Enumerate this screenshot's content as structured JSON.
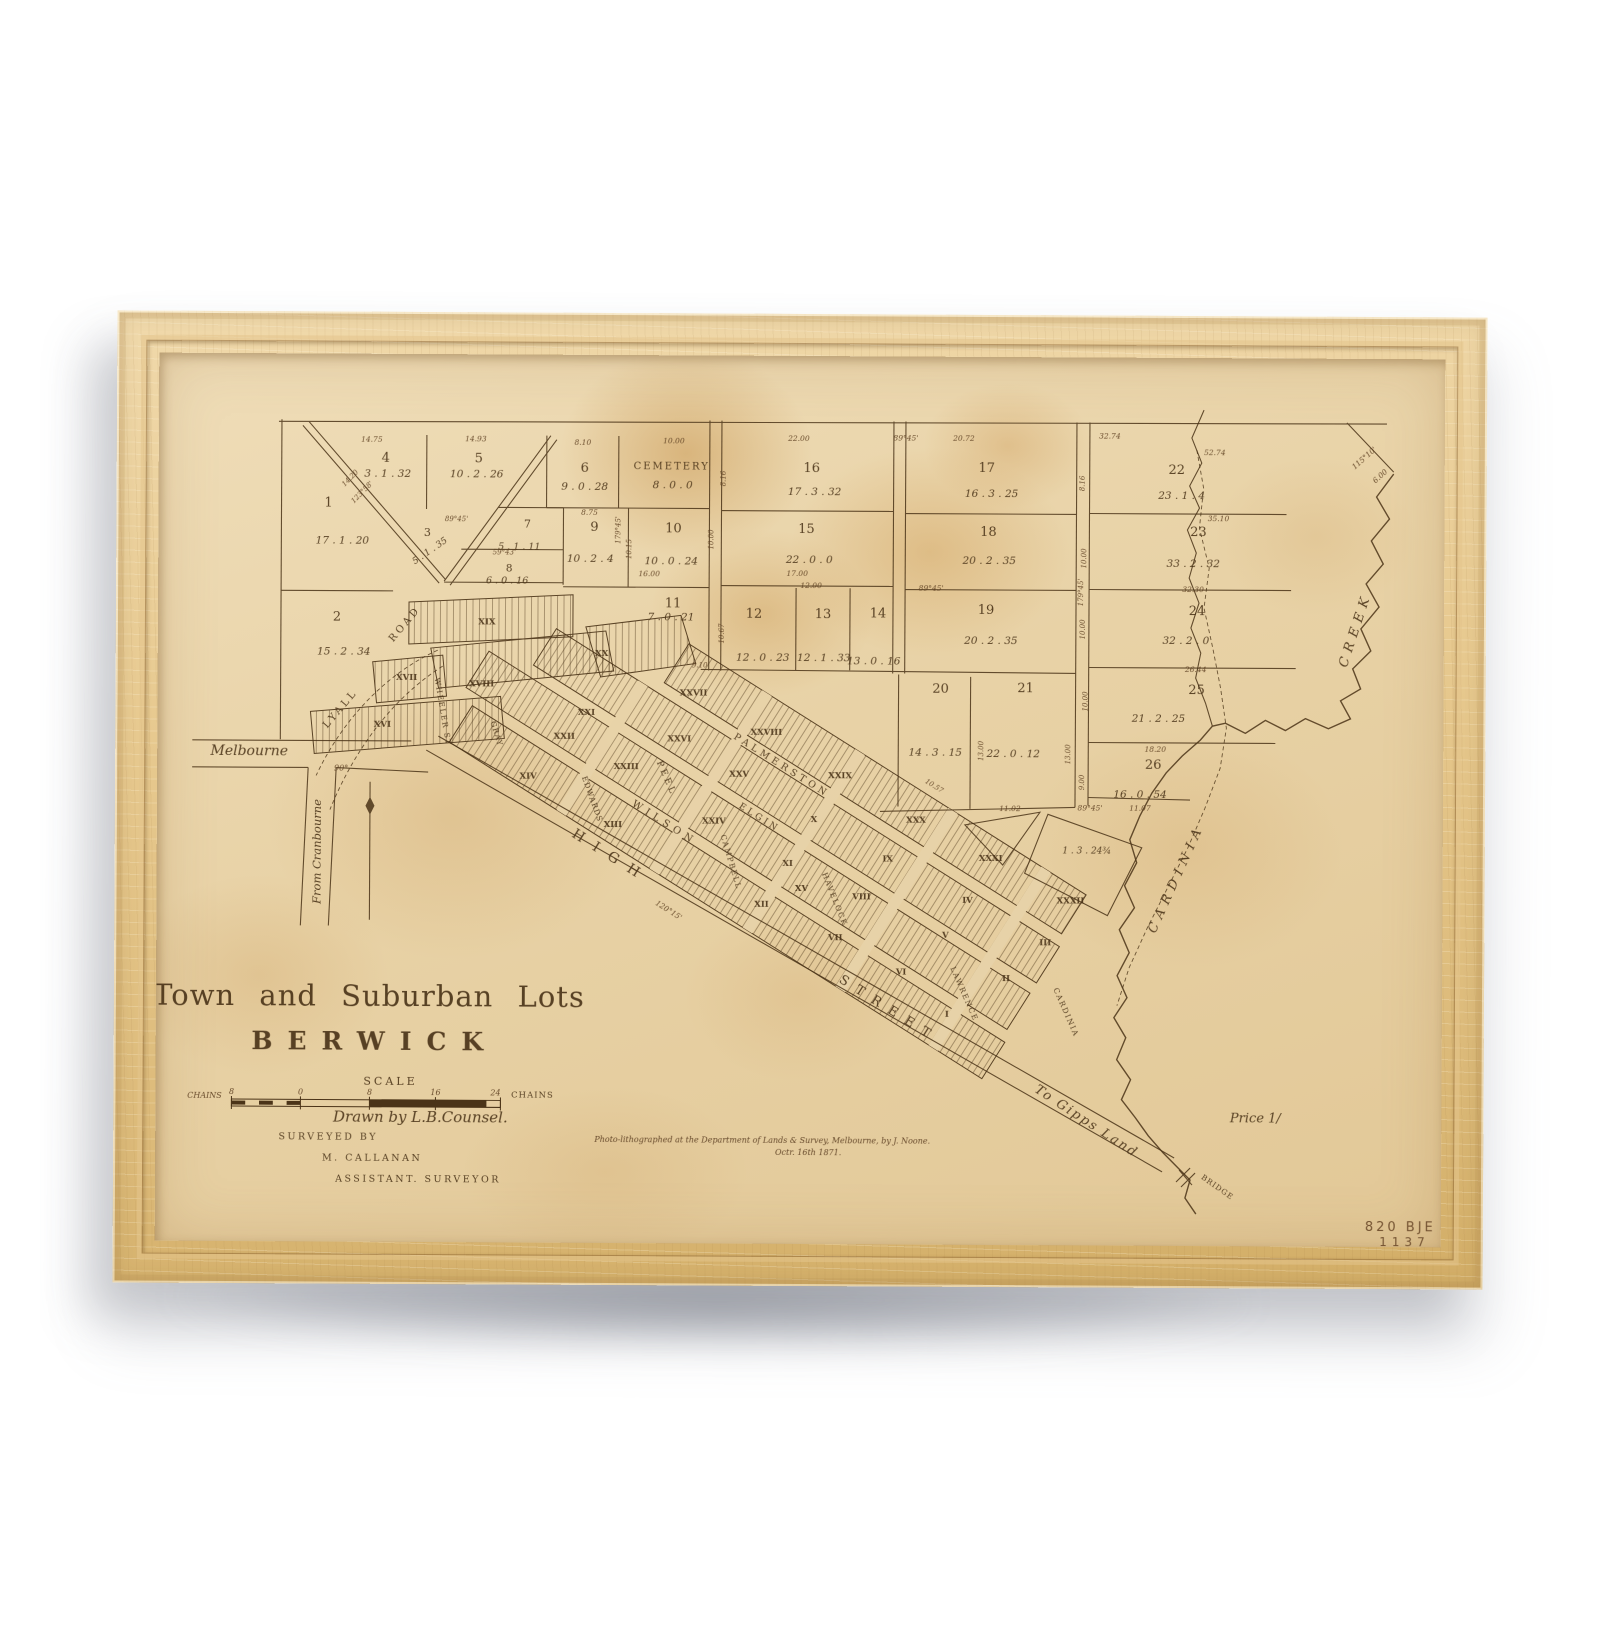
{
  "page": {
    "background": "#ffffff"
  },
  "frame": {
    "material": "natural-wood-frame"
  },
  "map": {
    "colors": {
      "ink": "#4b3418",
      "ink_light": "#5f4122",
      "paper": "#e8d3a9",
      "wood": "#e3c489"
    },
    "scale": {
      "heading": "SCALE",
      "unit": "CHAINS",
      "ticks": [
        "8",
        "0",
        "8",
        "16",
        "24"
      ]
    },
    "labels": [
      {
        "t": "Town and Suburban Lots",
        "x": 330,
        "y": 992,
        "s": "t1"
      },
      {
        "t": "BERWICK",
        "x": 336,
        "y": 1036,
        "s": "t2"
      },
      {
        "t": "SCALE",
        "x": 352,
        "y": 1071,
        "s": "cap",
        "z": 11,
        "ls": 3
      },
      {
        "t": "CHAINS",
        "x": 166,
        "y": 1085,
        "s": "ms",
        "z": 8
      },
      {
        "t": "8",
        "x": 193,
        "y": 1081,
        "s": "ms",
        "z": 8
      },
      {
        "t": "0",
        "x": 262,
        "y": 1081,
        "s": "ms",
        "z": 8
      },
      {
        "t": "8",
        "x": 331,
        "y": 1081,
        "s": "ms",
        "z": 8
      },
      {
        "t": "16",
        "x": 397,
        "y": 1081,
        "s": "ms",
        "z": 8
      },
      {
        "t": "24",
        "x": 457,
        "y": 1081,
        "s": "ms",
        "z": 8
      },
      {
        "t": "CHAINS",
        "x": 494,
        "y": 1083,
        "s": "cap",
        "z": 8.5,
        "ls": 1
      },
      {
        "t": "Drawn by L.B.Counsel.",
        "x": 382,
        "y": 1108,
        "s": "scr",
        "z": 15
      },
      {
        "t": "SURVEYED BY",
        "x": 290,
        "y": 1126,
        "s": "cap",
        "ls": 2.5
      },
      {
        "t": "M. CALLANAN",
        "x": 334,
        "y": 1147,
        "s": "cap",
        "ls": 2.5
      },
      {
        "t": "ASSISTANT. SURVEYOR",
        "x": 380,
        "y": 1168,
        "s": "cap",
        "ls": 2.5
      },
      {
        "t": "Photo-lithographed at the Department of Lands & Survey, Melbourne, by J. Noone.",
        "x": 724,
        "y": 1127,
        "s": "imp"
      },
      {
        "t": "Octr. 16th 1871.",
        "x": 770,
        "y": 1139,
        "s": "imp"
      },
      {
        "t": "Price 1/",
        "x": 1217,
        "y": 1104,
        "s": "scr",
        "z": 13
      },
      {
        "t": "820 BJE",
        "x": 1398,
        "y": 1212,
        "s": "cat",
        "a": "end"
      },
      {
        "t": "1137",
        "x": 1392,
        "y": 1227,
        "s": "cat",
        "z": 12,
        "ls": 5,
        "a": "end"
      },
      {
        "t": "Melbourne",
        "x": 209,
        "y": 742,
        "s": "scr",
        "z": 14
      },
      {
        "t": "From Cranbourne",
        "x": 281,
        "y": 838,
        "s": "scr",
        "z": 11.5,
        "r": -90
      },
      {
        "t": "To Gipps Land",
        "x": 1046,
        "y": 1107,
        "s": "scr",
        "z": 13,
        "r": 33,
        "ls": 2
      },
      {
        "t": "BRIDGE",
        "x": 1178,
        "y": 1171,
        "s": "cap",
        "z": 7.5,
        "r": 35,
        "ls": 1
      },
      {
        "t": "CARDINIA",
        "x": 1140,
        "y": 862,
        "s": "crk",
        "r": -66
      },
      {
        "t": "CREEK",
        "x": 1318,
        "y": 612,
        "s": "crk",
        "r": -72
      },
      {
        "t": "90°",
        "x": 301,
        "y": 757,
        "s": "ms",
        "z": 8
      },
      {
        "t": "CEMETERY",
        "x": 630,
        "y": 454,
        "s": "cap",
        "z": 10,
        "ls": 2
      },
      {
        "t": "8 . 0 . 0",
        "x": 631,
        "y": 473,
        "s": "val"
      },
      {
        "t": "1",
        "x": 287,
        "y": 493,
        "s": "num"
      },
      {
        "t": "17 . 1 . 20",
        "x": 301,
        "y": 530,
        "s": "val"
      },
      {
        "t": "2",
        "x": 296,
        "y": 607,
        "s": "num"
      },
      {
        "t": "15 . 2 . 34",
        "x": 303,
        "y": 641,
        "s": "val"
      },
      {
        "t": "3",
        "x": 386,
        "y": 522,
        "s": "num",
        "z": 11
      },
      {
        "t": "5 . 1 . 35",
        "x": 390,
        "y": 539,
        "s": "val",
        "z": 9,
        "r": -35
      },
      {
        "t": "4",
        "x": 344,
        "y": 448,
        "s": "num"
      },
      {
        "t": "3 . 1 . 32",
        "x": 346,
        "y": 463,
        "s": "val"
      },
      {
        "t": "5",
        "x": 437,
        "y": 448,
        "s": "num"
      },
      {
        "t": "10 . 2 . 26",
        "x": 435,
        "y": 463,
        "s": "val"
      },
      {
        "t": "6",
        "x": 543,
        "y": 457,
        "s": "num"
      },
      {
        "t": "9 . 0 . 28",
        "x": 543,
        "y": 475,
        "s": "val"
      },
      {
        "t": "7",
        "x": 486,
        "y": 513,
        "s": "num",
        "z": 11
      },
      {
        "t": "5 . 1 . 11",
        "x": 478,
        "y": 535,
        "s": "val",
        "z": 9.5
      },
      {
        "t": "8",
        "x": 468,
        "y": 557,
        "s": "num",
        "z": 10.5
      },
      {
        "t": "6 . 0 . 16",
        "x": 466,
        "y": 569,
        "s": "val",
        "z": 9.5
      },
      {
        "t": "9",
        "x": 553,
        "y": 516,
        "s": "num"
      },
      {
        "t": "10 . 2 . 4",
        "x": 549,
        "y": 547,
        "s": "val"
      },
      {
        "t": "10",
        "x": 632,
        "y": 517,
        "s": "num"
      },
      {
        "t": "10 . 0 . 24",
        "x": 630,
        "y": 549,
        "s": "val"
      },
      {
        "t": "11",
        "x": 632,
        "y": 592,
        "s": "num"
      },
      {
        "t": "7 . 0 . 21",
        "x": 630,
        "y": 605,
        "s": "val"
      },
      {
        "t": "12",
        "x": 713,
        "y": 602,
        "s": "num"
      },
      {
        "t": "12 . 0 . 23",
        "x": 722,
        "y": 645,
        "s": "val"
      },
      {
        "t": "13",
        "x": 782,
        "y": 602,
        "s": "num"
      },
      {
        "t": "12 . 1 . 33",
        "x": 783,
        "y": 645,
        "s": "val"
      },
      {
        "t": "14",
        "x": 837,
        "y": 601,
        "s": "num"
      },
      {
        "t": "13 . 0 . 16",
        "x": 833,
        "y": 648,
        "s": "val"
      },
      {
        "t": "15",
        "x": 765,
        "y": 517,
        "s": "num"
      },
      {
        "t": "22 . 0 . 0",
        "x": 768,
        "y": 547,
        "s": "val"
      },
      {
        "t": "16",
        "x": 770,
        "y": 456,
        "s": "num"
      },
      {
        "t": "17 . 3 . 32",
        "x": 773,
        "y": 479,
        "s": "val"
      },
      {
        "t": "17",
        "x": 945,
        "y": 455,
        "s": "num"
      },
      {
        "t": "16 . 3 . 25",
        "x": 950,
        "y": 480,
        "s": "val"
      },
      {
        "t": "18",
        "x": 947,
        "y": 519,
        "s": "num"
      },
      {
        "t": "20 . 2 . 35",
        "x": 948,
        "y": 547,
        "s": "val"
      },
      {
        "t": "19",
        "x": 945,
        "y": 597,
        "s": "num"
      },
      {
        "t": "20 . 2 . 35",
        "x": 950,
        "y": 627,
        "s": "val"
      },
      {
        "t": "20",
        "x": 900,
        "y": 676,
        "s": "num"
      },
      {
        "t": "14 . 3 . 15",
        "x": 895,
        "y": 739,
        "s": "val"
      },
      {
        "t": "21",
        "x": 985,
        "y": 675,
        "s": "num"
      },
      {
        "t": "22 . 0 . 12",
        "x": 973,
        "y": 740,
        "s": "val"
      },
      {
        "t": "22",
        "x": 1135,
        "y": 456,
        "s": "num"
      },
      {
        "t": "23 . 1 . 4",
        "x": 1140,
        "y": 481,
        "s": "val"
      },
      {
        "t": "23",
        "x": 1157,
        "y": 518,
        "s": "num"
      },
      {
        "t": "33 . 2 . 32",
        "x": 1152,
        "y": 549,
        "s": "val"
      },
      {
        "t": "24",
        "x": 1156,
        "y": 597,
        "s": "num"
      },
      {
        "t": "32 . 2 . 0",
        "x": 1145,
        "y": 626,
        "s": "val"
      },
      {
        "t": "25",
        "x": 1156,
        "y": 676,
        "s": "num"
      },
      {
        "t": "21 . 2 . 25",
        "x": 1118,
        "y": 704,
        "s": "val"
      },
      {
        "t": "26",
        "x": 1113,
        "y": 751,
        "s": "num"
      },
      {
        "t": "16 . 0 . 54",
        "x": 1100,
        "y": 780,
        "s": "val"
      },
      {
        "t": "1 . 3 . 24¾",
        "x": 1047,
        "y": 836,
        "s": "val",
        "z": 9
      },
      {
        "t": "XVI",
        "x": 342,
        "y": 713,
        "s": "blk"
      },
      {
        "t": "XVII",
        "x": 366,
        "y": 666,
        "s": "blk"
      },
      {
        "t": "XVIII",
        "x": 441,
        "y": 672,
        "s": "blk"
      },
      {
        "t": "XIX",
        "x": 446,
        "y": 610,
        "s": "blk"
      },
      {
        "t": "XX",
        "x": 561,
        "y": 641,
        "s": "blk"
      },
      {
        "t": "XXI",
        "x": 546,
        "y": 700,
        "s": "blk"
      },
      {
        "t": "XXII",
        "x": 524,
        "y": 724,
        "s": "blk"
      },
      {
        "t": "XXIII",
        "x": 586,
        "y": 754,
        "s": "blk"
      },
      {
        "t": "XXIV",
        "x": 674,
        "y": 808,
        "s": "blk"
      },
      {
        "t": "XXV",
        "x": 699,
        "y": 761,
        "s": "blk"
      },
      {
        "t": "XXVI",
        "x": 639,
        "y": 726,
        "s": "blk"
      },
      {
        "t": "XXVII",
        "x": 653,
        "y": 680,
        "s": "blk"
      },
      {
        "t": "XXVIII",
        "x": 726,
        "y": 719,
        "s": "blk"
      },
      {
        "t": "XXIX",
        "x": 800,
        "y": 762,
        "s": "blk"
      },
      {
        "t": "XXX",
        "x": 876,
        "y": 806,
        "s": "blk"
      },
      {
        "t": "XXXI",
        "x": 951,
        "y": 844,
        "s": "blk"
      },
      {
        "t": "XXXII",
        "x": 1031,
        "y": 886,
        "s": "blk"
      },
      {
        "t": "XIII",
        "x": 573,
        "y": 812,
        "s": "blk"
      },
      {
        "t": "XIV",
        "x": 488,
        "y": 764,
        "s": "blk"
      },
      {
        "t": "XV",
        "x": 762,
        "y": 875,
        "s": "blk"
      },
      {
        "t": "XII",
        "x": 722,
        "y": 891,
        "s": "blk"
      },
      {
        "t": "XI",
        "x": 748,
        "y": 850,
        "s": "blk"
      },
      {
        "t": "X",
        "x": 774,
        "y": 806,
        "s": "blk"
      },
      {
        "t": "IX",
        "x": 848,
        "y": 845,
        "s": "blk"
      },
      {
        "t": "VIII",
        "x": 822,
        "y": 883,
        "s": "blk"
      },
      {
        "t": "VII",
        "x": 796,
        "y": 924,
        "s": "blk"
      },
      {
        "t": "VI",
        "x": 862,
        "y": 958,
        "s": "blk"
      },
      {
        "t": "V",
        "x": 906,
        "y": 921,
        "s": "blk"
      },
      {
        "t": "IV",
        "x": 928,
        "y": 886,
        "s": "blk"
      },
      {
        "t": "III",
        "x": 1006,
        "y": 928,
        "s": "blk"
      },
      {
        "t": "II",
        "x": 967,
        "y": 964,
        "s": "blk"
      },
      {
        "t": "I",
        "x": 908,
        "y": 1000,
        "s": "blk"
      },
      {
        "t": "LYALL",
        "x": 302,
        "y": 697,
        "s": "st",
        "z": 10,
        "r": -50,
        "ls": 3
      },
      {
        "t": "ROAD",
        "x": 366,
        "y": 612,
        "s": "st",
        "z": 10,
        "r": -50,
        "ls": 3
      },
      {
        "t": "WHEELER ST",
        "x": 400,
        "y": 698,
        "s": "st",
        "z": 7.5,
        "r": 80,
        "ls": 1.5
      },
      {
        "t": "GRAY",
        "x": 454,
        "y": 720,
        "s": "st",
        "z": 7.5,
        "r": 72,
        "ls": 1
      },
      {
        "t": "EDWARDS",
        "x": 550,
        "y": 785,
        "s": "st",
        "z": 7.5,
        "r": 70,
        "ls": 1
      },
      {
        "t": "WILSON",
        "x": 623,
        "y": 810,
        "s": "st",
        "z": 10,
        "r": 32,
        "ls": 5
      },
      {
        "t": "PEEL",
        "x": 624,
        "y": 764,
        "s": "st",
        "z": 9,
        "r": 66,
        "ls": 3
      },
      {
        "t": "PALMERSTON",
        "x": 740,
        "y": 752,
        "s": "st",
        "z": 9.5,
        "r": 32,
        "ls": 4
      },
      {
        "t": "ELGIN",
        "x": 718,
        "y": 804,
        "s": "st",
        "z": 9,
        "r": 32,
        "ls": 3
      },
      {
        "t": "CAMPBELL",
        "x": 689,
        "y": 847,
        "s": "st",
        "z": 7.5,
        "r": 73,
        "ls": 1.5
      },
      {
        "t": "HAVELOCK",
        "x": 793,
        "y": 884,
        "s": "st",
        "z": 7.5,
        "r": 68,
        "ls": 1.5
      },
      {
        "t": "LAWRENCE",
        "x": 923,
        "y": 978,
        "s": "st",
        "z": 7.5,
        "r": 66,
        "ls": 1.5
      },
      {
        "t": "CARDINIA",
        "x": 1025,
        "y": 996,
        "s": "st",
        "z": 7.5,
        "r": 66,
        "ls": 1.5
      },
      {
        "t": "HIGH",
        "x": 569,
        "y": 845,
        "s": "st",
        "z": 14,
        "r": 32,
        "ls": 12
      },
      {
        "t": "STREET",
        "x": 848,
        "y": 996,
        "s": "st",
        "z": 13,
        "r": 32,
        "ls": 10
      },
      {
        "t": "14.75",
        "x": 330,
        "y": 428,
        "s": "ms"
      },
      {
        "t": "14.93",
        "x": 434,
        "y": 427,
        "s": "ms"
      },
      {
        "t": "8.10",
        "x": 541,
        "y": 430,
        "s": "ms"
      },
      {
        "t": "10.00",
        "x": 632,
        "y": 428,
        "s": "ms"
      },
      {
        "t": "22.00",
        "x": 757,
        "y": 425,
        "s": "ms"
      },
      {
        "t": "89°45'",
        "x": 864,
        "y": 424,
        "s": "ms"
      },
      {
        "t": "20.72",
        "x": 922,
        "y": 424,
        "s": "ms"
      },
      {
        "t": "32.74",
        "x": 1068,
        "y": 421,
        "s": "ms"
      },
      {
        "t": "52.74",
        "x": 1173,
        "y": 437,
        "s": "ms"
      },
      {
        "t": "115°10'",
        "x": 1324,
        "y": 441,
        "s": "ms",
        "r": -42
      },
      {
        "t": "6.00",
        "x": 1340,
        "y": 459,
        "s": "ms",
        "r": -42
      },
      {
        "t": "8.75",
        "x": 548,
        "y": 500,
        "s": "ms"
      },
      {
        "t": "179°45'",
        "x": 579,
        "y": 515,
        "s": "ms",
        "z": 7,
        "r": -90
      },
      {
        "t": "10.15",
        "x": 590,
        "y": 534,
        "s": "ms",
        "z": 7,
        "r": -90
      },
      {
        "t": "8.16",
        "x": 684,
        "y": 463,
        "s": "ms",
        "z": 7,
        "r": -90
      },
      {
        "t": "10.00",
        "x": 672,
        "y": 524,
        "s": "ms",
        "z": 7,
        "r": -90
      },
      {
        "t": "16.00",
        "x": 608,
        "y": 561,
        "s": "ms"
      },
      {
        "t": "17.00",
        "x": 756,
        "y": 560,
        "s": "ms"
      },
      {
        "t": "12.00",
        "x": 770,
        "y": 572,
        "s": "ms"
      },
      {
        "t": "89°45'",
        "x": 890,
        "y": 574,
        "s": "ms"
      },
      {
        "t": "10.67",
        "x": 683,
        "y": 618,
        "s": "ms",
        "z": 7,
        "r": -90
      },
      {
        "t": "9.10",
        "x": 659,
        "y": 652,
        "s": "ms",
        "z": 7
      },
      {
        "t": "13.00",
        "x": 943,
        "y": 734,
        "s": "ms",
        "z": 7,
        "r": -90
      },
      {
        "t": "8.16",
        "x": 1043,
        "y": 466,
        "s": "ms",
        "z": 7,
        "r": -90
      },
      {
        "t": "10.00",
        "x": 1045,
        "y": 541,
        "s": "ms",
        "z": 7,
        "r": -90
      },
      {
        "t": "179°45'",
        "x": 1042,
        "y": 575,
        "s": "ms",
        "z": 7,
        "r": -90
      },
      {
        "t": "10.00",
        "x": 1044,
        "y": 612,
        "s": "ms",
        "z": 7,
        "r": -90
      },
      {
        "t": "10.00",
        "x": 1047,
        "y": 684,
        "s": "ms",
        "z": 7,
        "r": -90
      },
      {
        "t": "13.00",
        "x": 1030,
        "y": 737,
        "s": "ms",
        "z": 7,
        "r": -90
      },
      {
        "t": "9.00",
        "x": 1044,
        "y": 765,
        "s": "ms",
        "z": 7,
        "r": -90
      },
      {
        "t": "35.10",
        "x": 1177,
        "y": 503,
        "s": "ms"
      },
      {
        "t": "32.30",
        "x": 1152,
        "y": 574,
        "s": "ms"
      },
      {
        "t": "26.44",
        "x": 1155,
        "y": 654,
        "s": "ms"
      },
      {
        "t": "18.20",
        "x": 1115,
        "y": 734,
        "s": "ms"
      },
      {
        "t": "11.02",
        "x": 970,
        "y": 794,
        "s": "ms"
      },
      {
        "t": "89°45'",
        "x": 1050,
        "y": 793,
        "s": "ms"
      },
      {
        "t": "11.07",
        "x": 1100,
        "y": 793,
        "s": "ms"
      },
      {
        "t": "120°15'",
        "x": 628,
        "y": 897,
        "s": "ms",
        "r": 32
      },
      {
        "t": "10.57",
        "x": 893,
        "y": 771,
        "s": "ms",
        "z": 7,
        "r": 32
      },
      {
        "t": "123°58'",
        "x": 322,
        "y": 480,
        "s": "ms",
        "z": 7,
        "r": -46
      },
      {
        "t": "14.20",
        "x": 310,
        "y": 466,
        "s": "ms",
        "z": 7,
        "r": -46
      },
      {
        "t": "89°45'",
        "x": 415,
        "y": 507,
        "s": "ms",
        "z": 7
      },
      {
        "t": "59°43'",
        "x": 463,
        "y": 540,
        "s": "ms",
        "z": 7
      }
    ]
  }
}
